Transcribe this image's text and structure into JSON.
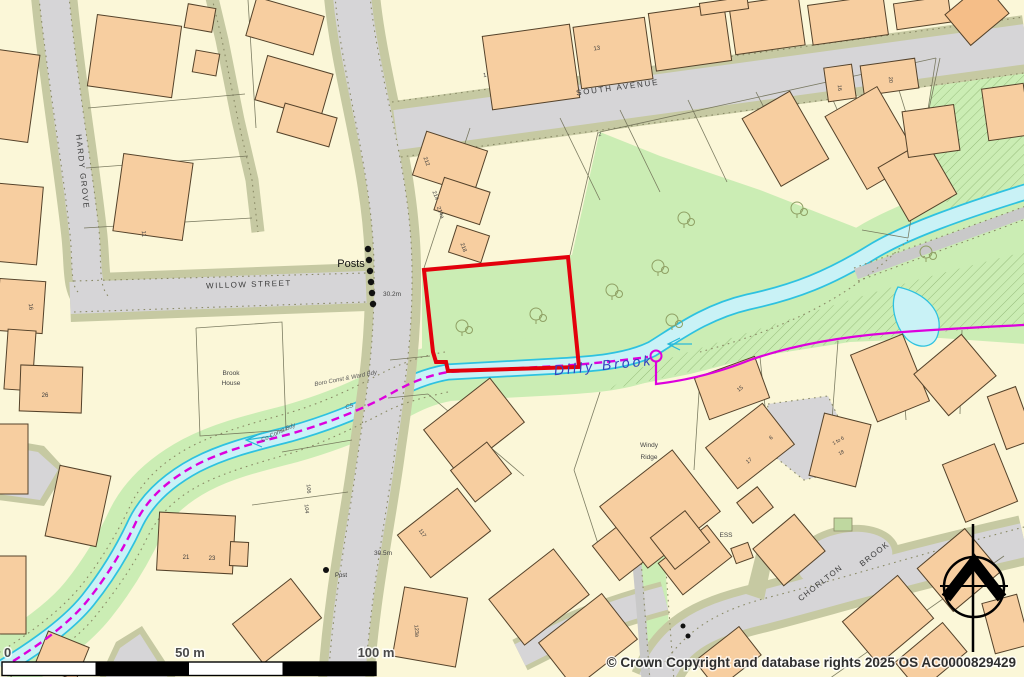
{
  "copyright": "© Crown Copyright and database rights 2025 OS AC0000829429",
  "scale_bar": {
    "start_label": "0",
    "mid_label": "50 m",
    "end_label": "100 m"
  },
  "colors": {
    "background": "#FBF7D8",
    "building": "#F7CEA0",
    "road": "#D6D5D7",
    "verge": "#C6C9A2",
    "green": "#CBEDB4",
    "water_fill": "#C9F2F6",
    "water_edge": "#2EC2E0",
    "site_boundary": "#E3000C",
    "admin_boundary": "#DD00DD",
    "water_label": "#3340C0"
  },
  "map": {
    "labels": [
      {
        "name": "street-label-south-avenue",
        "text": "SOUTH AVENUE",
        "x": 618,
        "y": 90,
        "rot": -7.5,
        "fs": 8,
        "ls": 1.8,
        "col": "#3c3c3c"
      },
      {
        "name": "street-label-willow-street",
        "text": "WILLOW STREET",
        "x": 249,
        "y": 287,
        "rot": -2,
        "fs": 8,
        "ls": 1.5,
        "col": "#3c3c3c"
      },
      {
        "name": "street-label-hardy-grove",
        "text": "HARDY GROVE",
        "x": 80,
        "y": 172,
        "rot": 84,
        "fs": 8,
        "ls": 1.5,
        "col": "#3c3c3c"
      },
      {
        "name": "street-label-chorlton",
        "text": "CHORLTON",
        "x": 822,
        "y": 585,
        "rot": -38,
        "fs": 8,
        "ls": 1.2,
        "col": "#3c3c3c"
      },
      {
        "name": "street-label-brook",
        "text": "BROOK",
        "x": 876,
        "y": 556,
        "rot": -38,
        "fs": 8,
        "ls": 1.2,
        "col": "#3c3c3c"
      },
      {
        "name": "water-label-dilly-brook",
        "text": "Dilly Brook",
        "x": 604,
        "y": 370,
        "rot": -6,
        "fs": 14,
        "ls": 3,
        "col": "#3340C0",
        "it": true
      },
      {
        "name": "feature-label-posts",
        "text": "Posts",
        "x": 351,
        "y": 267,
        "fs": 11,
        "col": "#111111"
      },
      {
        "name": "feature-label-post",
        "text": "Post",
        "x": 341,
        "y": 577,
        "fs": 6,
        "col": "#333333"
      },
      {
        "name": "spot-height",
        "text": "30.2m",
        "x": 392,
        "y": 296,
        "fs": 6.5,
        "col": "#444444"
      },
      {
        "name": "spot-height",
        "text": "30.5m",
        "x": 383,
        "y": 555,
        "fs": 6.5,
        "col": "#444444"
      },
      {
        "name": "house-name-brook",
        "text": "Brook",
        "x": 231,
        "y": 375,
        "fs": 6.5,
        "col": "#444444"
      },
      {
        "name": "house-name-house",
        "text": "House",
        "x": 231,
        "y": 385,
        "fs": 6.5,
        "col": "#444444"
      },
      {
        "name": "house-name-windy",
        "text": "Windy",
        "x": 649,
        "y": 447,
        "fs": 6.5,
        "col": "#444444"
      },
      {
        "name": "house-name-ridge",
        "text": "Ridge",
        "x": 649,
        "y": 459,
        "fs": 6.5,
        "col": "#444444"
      },
      {
        "name": "feature-label-ess",
        "text": "ESS",
        "x": 726,
        "y": 537,
        "fs": 6.5,
        "col": "#444444"
      },
      {
        "name": "admin-label",
        "text": "Boro Const & Ward Bdy",
        "x": 346,
        "y": 380,
        "rot": -11,
        "fs": 6,
        "col": "#555555",
        "it": true
      },
      {
        "name": "admin-label",
        "text": "Co Const Bdy",
        "x": 279,
        "y": 434,
        "rot": -25,
        "fs": 6,
        "col": "#555555",
        "it": true
      },
      {
        "name": "admin-label",
        "text": "CS",
        "x": 350,
        "y": 408,
        "rot": -20,
        "fs": 6,
        "col": "#555555",
        "it": true
      },
      {
        "name": "house-number",
        "text": "1",
        "x": 485,
        "y": 77,
        "rot": -8,
        "fs": 6,
        "col": "#3c3c3c"
      },
      {
        "name": "house-number",
        "text": "13",
        "x": 597,
        "y": 50,
        "rot": -8,
        "fs": 6,
        "col": "#3c3c3c"
      },
      {
        "name": "house-number",
        "text": "11",
        "x": 142,
        "y": 234,
        "rot": 85,
        "fs": 6,
        "col": "#3c3c3c"
      },
      {
        "name": "house-number",
        "text": "16",
        "x": 29,
        "y": 307,
        "rot": 85,
        "fs": 6,
        "col": "#3c3c3c"
      },
      {
        "name": "house-number",
        "text": "26",
        "x": 45,
        "y": 397,
        "fs": 6,
        "col": "#3c3c3c"
      },
      {
        "name": "house-number",
        "text": "21",
        "x": 186,
        "y": 559,
        "fs": 6,
        "col": "#3c3c3c"
      },
      {
        "name": "house-number",
        "text": "23",
        "x": 212,
        "y": 560,
        "fs": 6,
        "col": "#3c3c3c"
      },
      {
        "name": "house-number",
        "text": "106",
        "x": 307,
        "y": 489,
        "rot": 85,
        "fs": 5.5,
        "col": "#3c3c3c"
      },
      {
        "name": "house-number",
        "text": "104",
        "x": 305,
        "y": 509,
        "rot": 85,
        "fs": 5.5,
        "col": "#3c3c3c"
      },
      {
        "name": "house-number",
        "text": "117",
        "x": 421,
        "y": 534,
        "rot": 55,
        "fs": 5.5,
        "col": "#3c3c3c"
      },
      {
        "name": "house-number",
        "text": "123a",
        "x": 415,
        "y": 631,
        "rot": 85,
        "fs": 5.5,
        "col": "#3c3c3c"
      },
      {
        "name": "house-number",
        "text": "212",
        "x": 425,
        "y": 162,
        "rot": 70,
        "fs": 5.5,
        "col": "#3c3c3c"
      },
      {
        "name": "house-number",
        "text": "214",
        "x": 434,
        "y": 196,
        "rot": 70,
        "fs": 5.5,
        "col": "#3c3c3c"
      },
      {
        "name": "house-number",
        "text": "214a",
        "x": 439,
        "y": 213,
        "rot": 70,
        "fs": 5.5,
        "col": "#3c3c3c"
      },
      {
        "name": "house-number",
        "text": "218",
        "x": 462,
        "y": 248,
        "rot": 70,
        "fs": 5.5,
        "col": "#3c3c3c"
      },
      {
        "name": "house-number",
        "text": "2",
        "x": 600,
        "y": 136,
        "rot": -8,
        "fs": 5.5,
        "col": "#3c3c3c"
      },
      {
        "name": "house-number",
        "text": "16",
        "x": 838,
        "y": 88,
        "rot": 85,
        "fs": 5.5,
        "col": "#3c3c3c"
      },
      {
        "name": "house-number",
        "text": "20",
        "x": 889,
        "y": 80,
        "rot": 85,
        "fs": 5.5,
        "col": "#3c3c3c"
      },
      {
        "name": "house-number",
        "text": "15",
        "x": 741,
        "y": 390,
        "rot": -38,
        "fs": 5.5,
        "col": "#3c3c3c"
      },
      {
        "name": "house-number",
        "text": "17",
        "x": 750,
        "y": 462,
        "rot": -38,
        "fs": 5.5,
        "col": "#3c3c3c"
      },
      {
        "name": "house-number",
        "text": "6",
        "x": 772,
        "y": 439,
        "rot": -38,
        "fs": 5.5,
        "col": "#3c3c3c"
      },
      {
        "name": "house-number",
        "text": "1 to 6",
        "x": 839,
        "y": 442,
        "rot": -30,
        "fs": 5,
        "col": "#3c3c3c"
      },
      {
        "name": "house-number",
        "text": "18",
        "x": 842,
        "y": 454,
        "rot": -30,
        "fs": 5,
        "col": "#3c3c3c"
      }
    ]
  }
}
